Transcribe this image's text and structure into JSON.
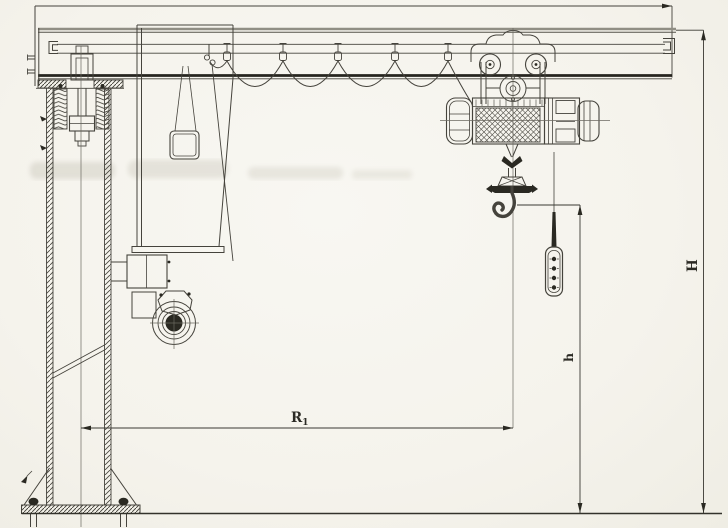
{
  "figure": {
    "kind": "scanned engineering line drawing",
    "subject": "Pillar-mounted slewing jib crane with electric wire-rope hoist - side elevation",
    "labels": {
      "radius_main": "R",
      "radius_sub": "1",
      "hook_height": "h",
      "overall_height": "H"
    },
    "palette": {
      "paper": "#f6f4ee",
      "ink": "#45433c",
      "ink_dark": "#2a2922",
      "ink_gray": "#908e84"
    }
  }
}
